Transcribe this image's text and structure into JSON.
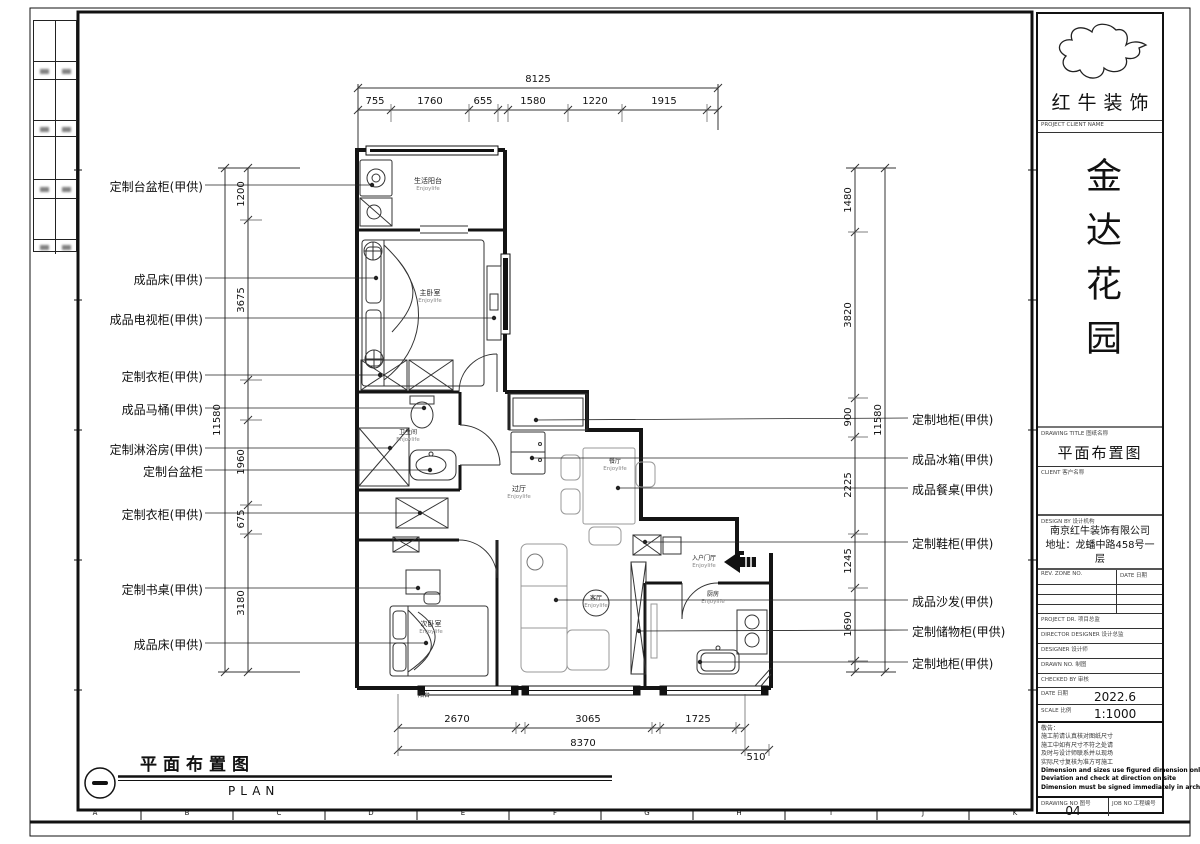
{
  "watermark": "Enjoylife",
  "logo": {
    "name": "红牛装饰",
    "sub_label": "PROJECT CLIENT NAME"
  },
  "title_block": {
    "project_name": "金达花园",
    "drawing_title_label": "DRAWING TITLE 图纸名称",
    "drawing_title": "平面布置图",
    "client_label": "CLIENT 客户名称",
    "design_by_label": "DESIGN BY 设计机构",
    "company_line1": "南京红牛装饰有限公司",
    "company_line2": "地址：龙蟠中路458号一层",
    "rev_header_no": "REV. ZONE NO.",
    "rev_header_date": "DATE 日期",
    "row_project_director": "PROJECT DR. 项目总监",
    "row_director_designer": "DIRECTOR DESIGNER 设计总监",
    "row_designer": "DESIGNER 设计师",
    "row_drawn": "DRAWN NO. 制图",
    "row_checked": "CHECKED BY 审核",
    "date_label": "DATE 日期",
    "date_value": "2022.6",
    "scale_label": "SCALE 比例",
    "scale_value": "1:1000",
    "notes": [
      "敬告：",
      "施工前请认真核对图纸尺寸",
      "施工中如有尺寸不符之处请",
      "及时与设计师联系并以现场",
      "实际尺寸复核为准方可施工",
      "Dimension and sizes use figured dimension only",
      "Deviation and check at direction on site",
      "Dimension must be signed immediately in architect"
    ],
    "drawing_no_label": "DRAWING NO 图号",
    "drawing_no": "04",
    "job_no_label": "JOB NO 工程编号"
  },
  "dims": {
    "top_total": "8125",
    "top_segments": [
      "755",
      "1760",
      "655",
      "1580",
      "1220",
      "1915"
    ],
    "left_total": "11580",
    "left_segments": [
      "1200",
      "3675",
      "1960",
      "675",
      "3180"
    ],
    "right_total": "11580",
    "right_segments": [
      "1480",
      "3820",
      "900",
      "2225",
      "1245",
      "1690"
    ],
    "bottom_segments": [
      "2670",
      "3065",
      "1725"
    ],
    "bottom_total": "8370",
    "bottom_extra": "510"
  },
  "labels": {
    "left": [
      "定制台盆柜(甲供)",
      "成品床(甲供)",
      "成品电视柜(甲供)",
      "定制衣柜(甲供)",
      "成品马桶(甲供)",
      "定制淋浴房(甲供)",
      "定制台盆柜",
      "定制衣柜(甲供)",
      "定制书桌(甲供)",
      "成品床(甲供)"
    ],
    "right": [
      "定制地柜(甲供)",
      "成品冰箱(甲供)",
      "成品餐桌(甲供)",
      "定制鞋柜(甲供)",
      "成品沙发(甲供)",
      "定制储物柜(甲供)",
      "定制地柜(甲供)"
    ]
  },
  "rooms": [
    "生活阳台",
    "主卧室",
    "卫生间",
    "过厅",
    "餐厅",
    "次卧室",
    "客厅",
    "入户门厅",
    "厨房",
    "阳台"
  ],
  "footer": {
    "title": "平面布置图",
    "plan": "PLAN"
  },
  "grid": {
    "letters": [
      "A",
      "B",
      "C",
      "D",
      "E",
      "F",
      "G",
      "H",
      "I",
      "J",
      "K"
    ]
  }
}
